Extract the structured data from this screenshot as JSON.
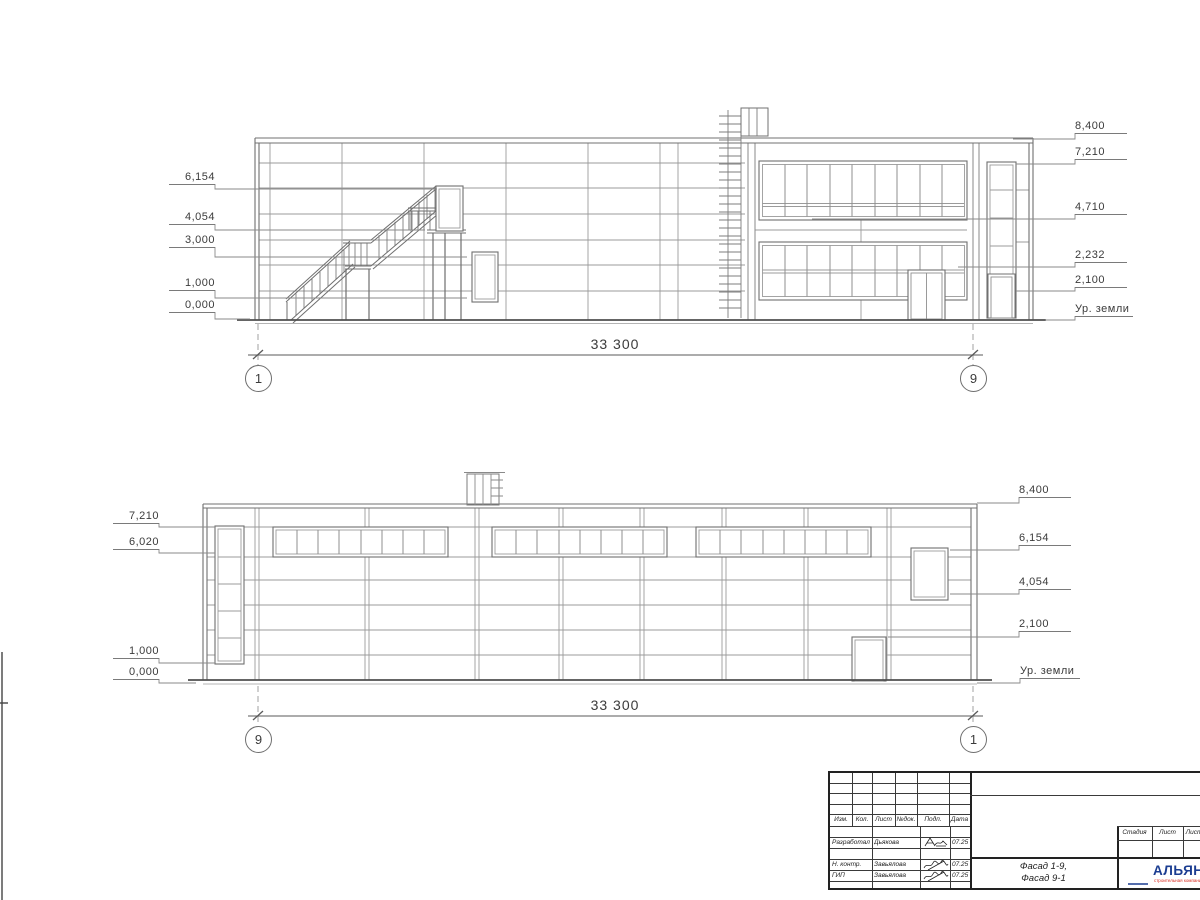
{
  "drawing": {
    "dim_top": "33 300",
    "dim_bottom": "33 300",
    "ground_label": "Ур. земли",
    "facade_top": {
      "left_marks": [
        "6,154",
        "4,054",
        "3,000",
        "1,000",
        "0,000"
      ],
      "right_marks": [
        "8,400",
        "7,210",
        "4,710",
        "2,232",
        "2,100"
      ],
      "axis_left": "1",
      "axis_right": "9"
    },
    "facade_bottom": {
      "left_marks": [
        "7,210",
        "6,020",
        "1,000",
        "0,000"
      ],
      "right_marks": [
        "8,400",
        "6,154",
        "4,054",
        "2,100"
      ],
      "axis_left": "9",
      "axis_right": "1"
    }
  },
  "title_block": {
    "header_cols": [
      "Изм.",
      "Кол.",
      "Лист",
      "№док.",
      "Подп.",
      "Дата"
    ],
    "rows": [
      {
        "role": "Разработал",
        "name": "Дьякова",
        "date": "07.25"
      },
      {
        "role": "Н. контр.",
        "name": "Завьялова",
        "date": "07.25"
      },
      {
        "role": "ГИП",
        "name": "Завьялова",
        "date": "07.25"
      }
    ],
    "doc_title_line1": "Фасад 1-9,",
    "doc_title_line2": "Фасад 9-1",
    "stage_header": [
      "Стадия",
      "Лист",
      "Листов"
    ],
    "logo": {
      "text": "АЛЬЯНС",
      "subtext": "строительная компания"
    }
  },
  "colors": {
    "line": "#8a8a8a",
    "frame": "#707070",
    "dark": "#222222",
    "logo_blue": "#2e59b5",
    "logo_red": "#d8291e"
  }
}
